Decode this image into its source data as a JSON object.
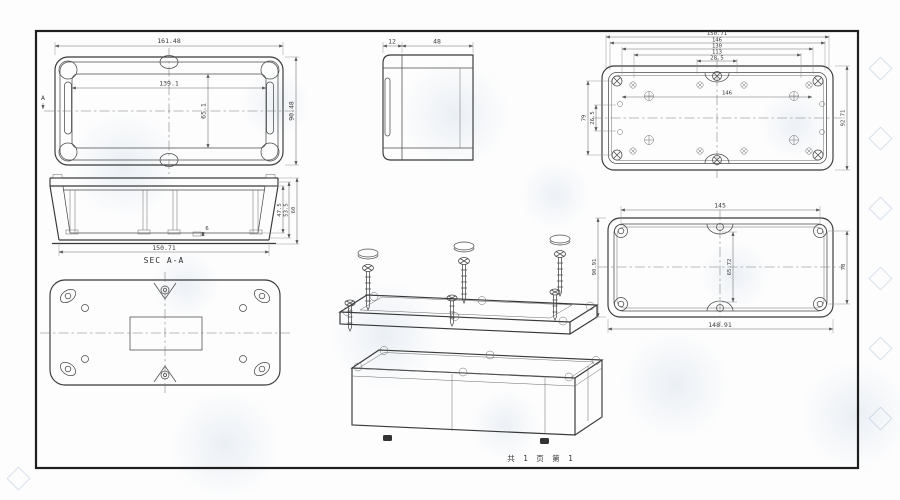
{
  "sheet": {
    "line_color": "#383838",
    "dim_color": "#6a6a6a",
    "watermark_color": "#96b2d0",
    "footer": {
      "page_note": "共 1 页  第 1"
    }
  },
  "views": {
    "lid_top": {
      "section_mark": "A",
      "dims": {
        "overall_width": "161.48",
        "inner_width": "139.1",
        "overall_depth": "90.48",
        "inner_depth": "65.1"
      }
    },
    "side": {
      "dims": {
        "lid_height": "12",
        "body_height": "48"
      }
    },
    "base_interior": {
      "dims": {
        "stack": [
          "150.71",
          "146",
          "130",
          "113",
          "28.5"
        ],
        "inner_width": "146",
        "overall_depth": "92.71",
        "hole_pitch_depth": "79",
        "center_pitch": "26.5"
      }
    },
    "section": {
      "label": "SEC A-A",
      "dims": {
        "width": "150.71",
        "overall_height": "60",
        "inner_height_1": "53.5",
        "inner_height_2": "47.5",
        "boss_height": "6"
      }
    },
    "lid_interior": {
      "dims": {
        "top_pitch": "145",
        "overall_width": "148.91",
        "overall_depth": "90.91",
        "side_pitch": "78",
        "center_pitch": "65.72"
      }
    }
  }
}
